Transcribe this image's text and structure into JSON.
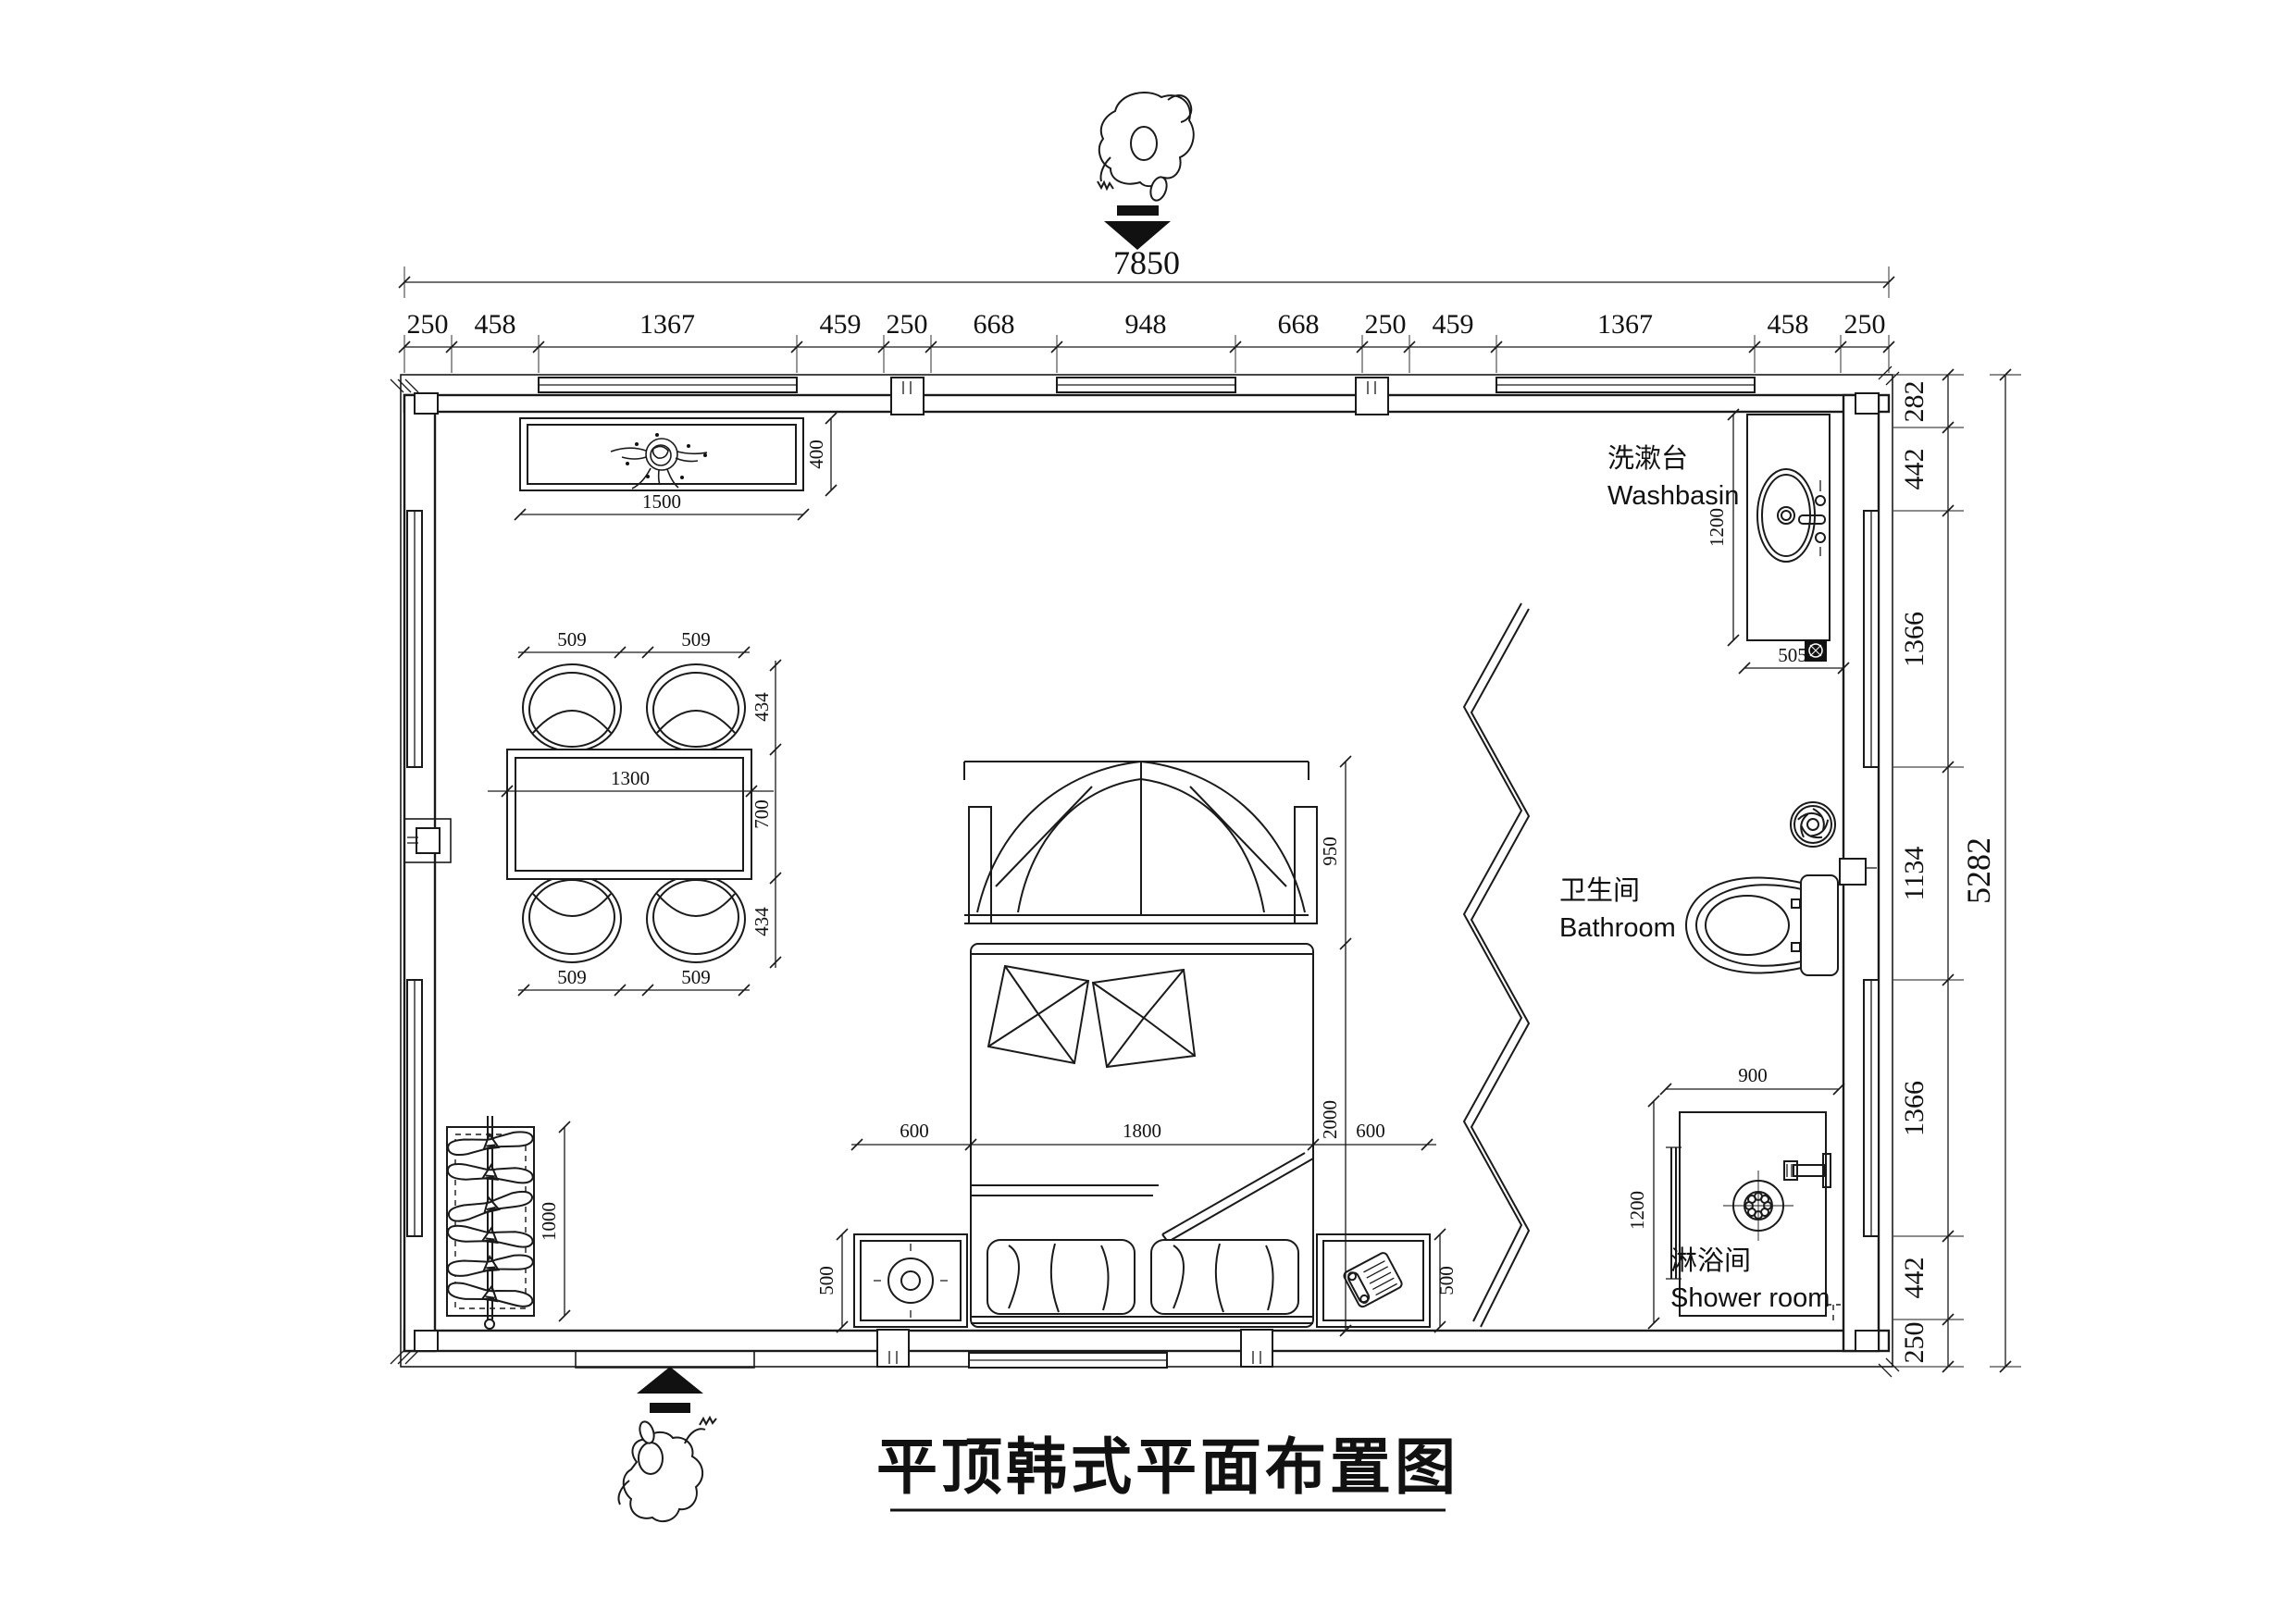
{
  "title": "平顶韩式平面布置图",
  "dim_chains": {
    "top": {
      "total": "7850",
      "segments": [
        "250",
        "458",
        "1367",
        "459",
        "250",
        "668",
        "948",
        "668",
        "250",
        "459",
        "1367",
        "458",
        "250"
      ]
    },
    "right": {
      "total": "5282",
      "segments": [
        "282",
        "442",
        "1366",
        "1134",
        "1366",
        "442",
        "250"
      ]
    }
  },
  "room_labels": {
    "washbasin": {
      "zh": "洗漱台",
      "en": "Washbasin"
    },
    "bathroom": {
      "zh": "卫生间",
      "en": "Bathroom"
    },
    "shower": {
      "zh": "淋浴间",
      "en": "Shower room"
    }
  },
  "furniture_dims": {
    "tv_width": "1500",
    "tv_depth": "400",
    "chair_width": "509",
    "chair_depth": "434",
    "table_width": "1300",
    "table_depth": "700",
    "canopy_depth": "950",
    "bed_width": "1800",
    "bed_length": "2000",
    "bed_side": "600",
    "nightstand_depth": "500",
    "wardrobe_length": "1000",
    "washbasin_length": "1200",
    "washbasin_width": "505",
    "shower_width": "900",
    "shower_depth": "1200"
  }
}
